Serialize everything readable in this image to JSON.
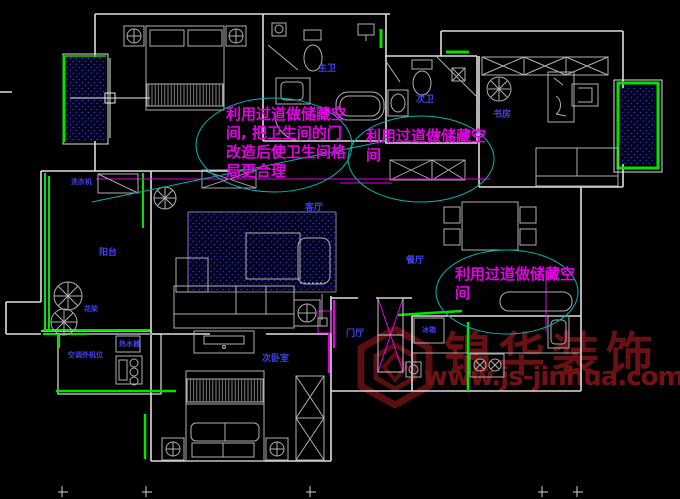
{
  "drawing": {
    "type": "cad-floor-plan",
    "background": "#000000"
  },
  "annotations": [
    {
      "id": "note-left",
      "lines": [
        "利用过道做储藏空",
        "间, 把卫生间的门",
        "改造后使卫生间格",
        "局更合理"
      ]
    },
    {
      "id": "note-middle",
      "lines": [
        "利用过道做储藏空",
        "间"
      ]
    },
    {
      "id": "note-right",
      "lines": [
        "利用过道做储藏空",
        "间"
      ]
    }
  ],
  "room_labels": [
    {
      "id": "master-bath",
      "text": "主卫"
    },
    {
      "id": "second-bath",
      "text": "次卫"
    },
    {
      "id": "study",
      "text": "书房"
    },
    {
      "id": "living-room",
      "text": "客厅"
    },
    {
      "id": "balcony",
      "text": "阳台"
    },
    {
      "id": "dining-room",
      "text": "餐厅"
    },
    {
      "id": "foyer",
      "text": "门厅"
    },
    {
      "id": "fridge",
      "text": "冰箱"
    },
    {
      "id": "second-bedroom",
      "text": "次卧室"
    },
    {
      "id": "ac-outdoor-unit",
      "text": "空调外机位"
    },
    {
      "id": "washer",
      "text": "洗衣机"
    },
    {
      "id": "water-heater",
      "text": "热水器"
    },
    {
      "id": "plant-rack",
      "text": "花架"
    }
  ],
  "watermark": {
    "brand": "锦华装饰",
    "url": "www.js-jinhua.com"
  },
  "icons": {
    "cursor": "crosshair-cursor",
    "logo": "hexagon-logo"
  },
  "colors": {
    "wall": "#dedede",
    "furniture": "#b0b0b0",
    "window_green": "#00e400",
    "window_speckle_blue": "#2b2bd4",
    "label_blue": "#4040f2",
    "annotation_magenta": "#e400e4",
    "highlight_cyan": "#00b4b4",
    "watermark_red": "#6b1013"
  }
}
